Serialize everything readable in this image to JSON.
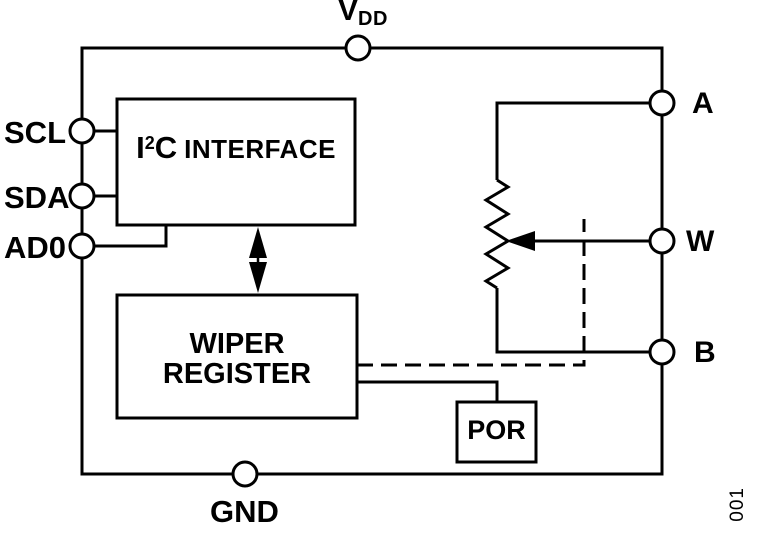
{
  "colors": {
    "stroke": "#000000",
    "background": "#ffffff"
  },
  "pins": {
    "vdd": {
      "letter": "V",
      "subscript": "DD"
    },
    "scl": {
      "label": "SCL"
    },
    "sda": {
      "label": "SDA"
    },
    "ad0": {
      "label": "AD0"
    },
    "a": {
      "label": "A"
    },
    "w": {
      "label": "W"
    },
    "b": {
      "label": "B"
    },
    "gnd": {
      "label": "GND"
    }
  },
  "blocks": {
    "i2c_interface": {
      "base": "I",
      "superscript": "2",
      "base2": "C",
      "word": "INTERFACE"
    },
    "wiper_register": {
      "line1": "WIPER",
      "line2": "REGISTER"
    },
    "por": {
      "label": "POR"
    }
  },
  "figure_number": "001"
}
